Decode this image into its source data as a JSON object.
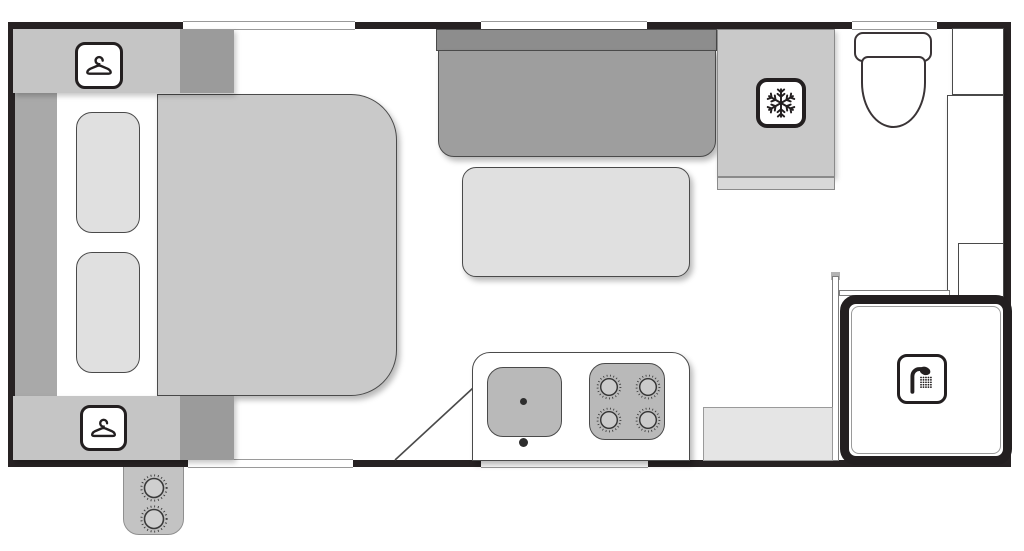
{
  "diagram": {
    "type": "caravan floor plan",
    "view": "top-down layout diagram",
    "text_content": "none (drawing only, no visible text)"
  },
  "labels": {
    "floorplan": "Caravan floor plan",
    "bed": "Bed",
    "pillow_left": "Pillow",
    "pillow_right": "Pillow",
    "bedside_shelf": "Bedside shelf",
    "wardrobe_front_top": "Wardrobe (hanging space)",
    "wardrobe_front_bottom": "Wardrobe (hanging space)",
    "dinette_sofa": "Dinette lounge seat",
    "dinette_table": "Dinette table",
    "fridge": "Refrigerator",
    "fridge_bench": "Bench edge below fridge",
    "kitchen_bench": "Kitchen bench",
    "sink": "Sink",
    "sink_drain": "Sink drain",
    "tap": "Tap",
    "cooktop": "Four-burner cooktop",
    "angled_panel": "Angled bench end at entry",
    "toilet": "Toilet",
    "toilet_cistern": "Toilet cistern",
    "toilet_bowl": "Toilet bowl",
    "cabinet_top": "Overhead cabinet",
    "cabinet_tall": "Tall bathroom cabinet",
    "cabinet_small": "Lower cabinet",
    "bathroom_bench": "Bathroom bench seat",
    "shower": "Shower cubicle",
    "partition_wall_vertical": "Bathroom partition wall",
    "partition_wall_horizontal": "Bathroom partition wall",
    "external_cooker": "External two-burner cooker",
    "entry_opening": "Entry door opening",
    "window_top_bed": "Window (over bed)",
    "window_top_dinette": "Window (over dinette)",
    "window_top_toilet": "Window (over toilet)",
    "window_bottom_kitchen": "Window (kitchen)"
  },
  "icons": {
    "wardrobe": "hanger-icon",
    "fridge": "snowflake-icon",
    "shower": "shower-head-icon",
    "cooktop": "burner-dial-icon"
  },
  "colors": {
    "wall": "#272223",
    "floor": "#ffffff",
    "bed": "#c9c9c9",
    "pillow": "#e0e0e0",
    "wardrobe_light": "#c5c5c5",
    "wardrobe_dark": "#9b9b9b",
    "bedside_shelf": "#a9a9a9",
    "sofa_backrest": "#8d8d8d",
    "sofa_seat": "#9e9e9e",
    "table": "#e0e0e0",
    "fridge": "#c9c9c9",
    "sink_stove": "#b9b9b9",
    "burner": "#cbcbcb",
    "bench": "#e5e5e5",
    "bbq": "#c3c3c3",
    "icon_line": "#231f20",
    "furniture_line": "#4a4a4a"
  },
  "counts": {
    "windows_top": 3,
    "windows_bottom": 1,
    "doors": 1,
    "cooktop_burners": 4,
    "external_burner_knobs": 2,
    "wardrobes": 2,
    "pillows": 2
  }
}
